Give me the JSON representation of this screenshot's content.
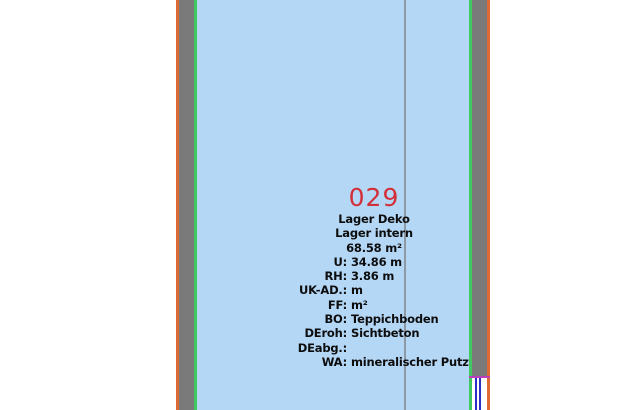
{
  "canvas": {
    "width": 620,
    "height": 410
  },
  "colors": {
    "background": "#ffffff",
    "room_fill": "#b4d7f6",
    "wall_gray": "#7a7a7a",
    "inner_line_green": "#3fc95f",
    "outer_line_orange": "#dd6a35",
    "section_line": "#8e99a6",
    "room_number_red": "#d32f38",
    "opening_line_magenta": "#bb3fbd",
    "glass_blue": "#2a2ec4",
    "text": "#0d0d0d"
  },
  "room": {
    "number": "029",
    "name_line1": "Lager Deko",
    "name_line2": "Lager intern",
    "area": "68.58 m²",
    "info": [
      {
        "label": "U:",
        "value": "34.86 m"
      },
      {
        "label": "RH:",
        "value": "3.86 m"
      },
      {
        "label": "UK-AD.:",
        "value": "m"
      },
      {
        "label": "FF:",
        "value": "m²"
      },
      {
        "label": "BO:",
        "value": "Teppichboden"
      },
      {
        "label": "DEroh:",
        "value": "Sichtbeton"
      },
      {
        "label": "DEabg.:",
        "value": ""
      },
      {
        "label": "WA:",
        "value": "mineralischer Putz"
      }
    ]
  }
}
